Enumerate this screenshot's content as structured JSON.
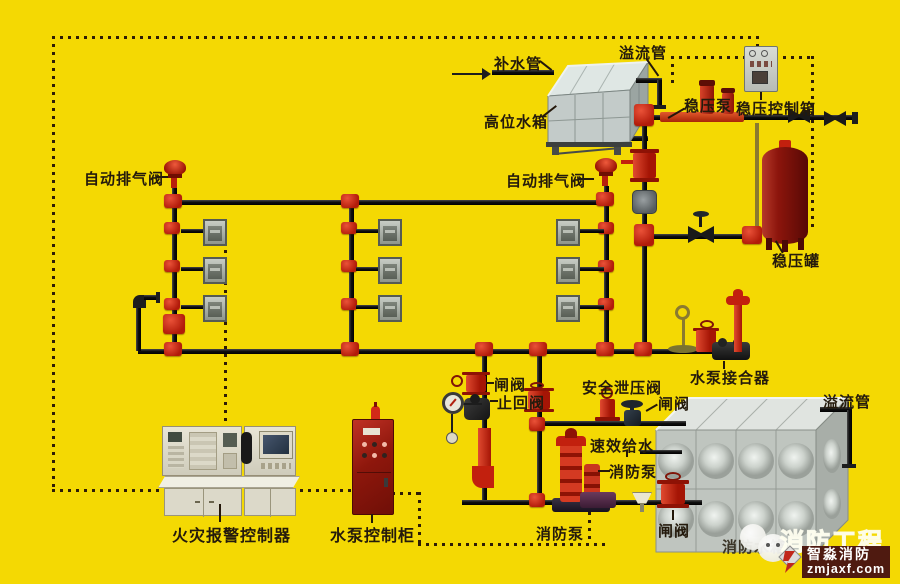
{
  "colors": {
    "background": "#f4d903",
    "pipe_black": "#1d1d1d",
    "fitting_red": "#c2200e",
    "pressure_tank_red": "#8c150c",
    "steel_gray": "#c3cbc9",
    "cabinet_red": "#8e170c",
    "console_beige": "#dcd9c9",
    "badge_bg": "#4f1a10"
  },
  "labels": {
    "water_supply_pipe": "补水管",
    "overflow_pipe_top": "溢流管",
    "high_level_tank": "高位水箱",
    "stabilizer_pump": "稳压泵",
    "stabilizer_control_box": "稳压控制箱",
    "auto_exhaust_valve_left": "自动排气阀",
    "auto_exhaust_valve_right": "自动排气阀",
    "stabilizer_tank": "稳压罐",
    "pump_coupler": "水泵接合器",
    "gate_valve_1": "闸阀",
    "check_valve": "止回阀",
    "safety_relief_valve": "安全泄压阀",
    "gate_valve_2": "闸阀",
    "quick_water_supply": "速效给水",
    "fire_pump_1": "消防泵",
    "overflow_pipe_bottom": "溢流管",
    "gate_valve_3": "闸阀",
    "fire_pump_2": "消防泵",
    "fire_alarm_controller": "火灾报警控制器",
    "pump_control_cabinet": "水泵控制柜",
    "fire_water_tank": "消防水箱"
  },
  "watermark": {
    "big_text": "消防工程",
    "brand": "智淼消防",
    "site": "zmjaxf.com"
  }
}
